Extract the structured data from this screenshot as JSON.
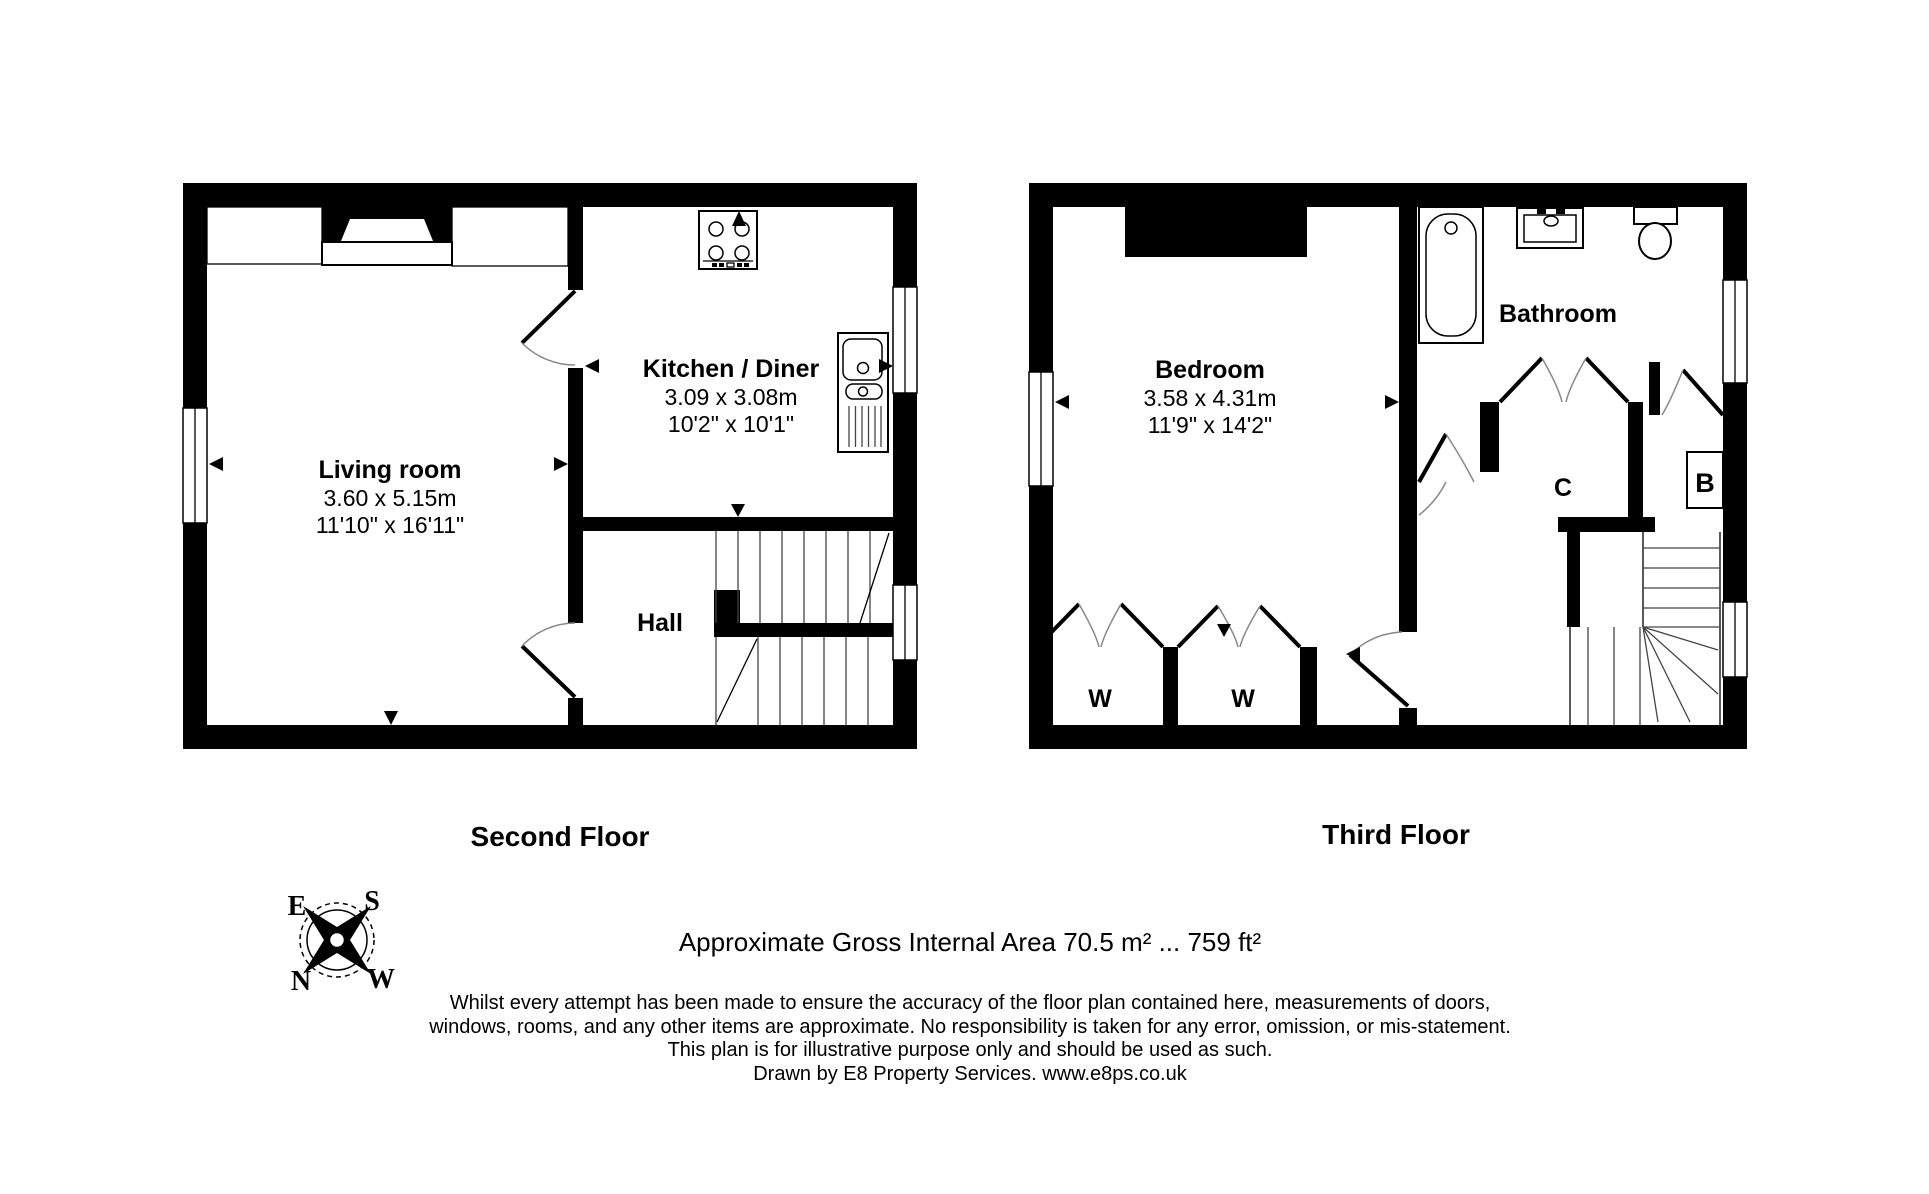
{
  "second_floor": {
    "title": "Second Floor",
    "living_room": {
      "name": "Living room",
      "metric": "3.60 x 5.15m",
      "imperial": "11'10\" x 16'11\""
    },
    "kitchen_diner": {
      "name": "Kitchen / Diner",
      "metric": "3.09 x 3.08m",
      "imperial": "10'2\" x 10'1\""
    },
    "hall": {
      "name": "Hall"
    }
  },
  "third_floor": {
    "title": "Third Floor",
    "bedroom": {
      "name": "Bedroom",
      "metric": "3.58 x 4.31m",
      "imperial": "11'9\" x 14'2\""
    },
    "bathroom": {
      "name": "Bathroom"
    },
    "wardrobe_left": "W",
    "wardrobe_right": "W",
    "cupboard": "C",
    "boiler": "B"
  },
  "compass": {
    "north": "N",
    "east": "E",
    "south": "S",
    "west": "W"
  },
  "footer": {
    "area_line": "Approximate Gross Internal Area 70.5 m² ... 759 ft²",
    "disclaimer_line1": "Whilst every attempt has been made to ensure the accuracy of the floor plan contained here, measurements of doors,",
    "disclaimer_line2": "windows, rooms, and any other items are approximate. No responsibility is taken for any error, omission, or mis-statement.",
    "disclaimer_line3": "This plan is for illustrative purpose only and should be used as such.",
    "disclaimer_line4": "Drawn by E8 Property Services. www.e8ps.co.uk"
  },
  "colors": {
    "ink": "#000000",
    "background": "#ffffff"
  }
}
